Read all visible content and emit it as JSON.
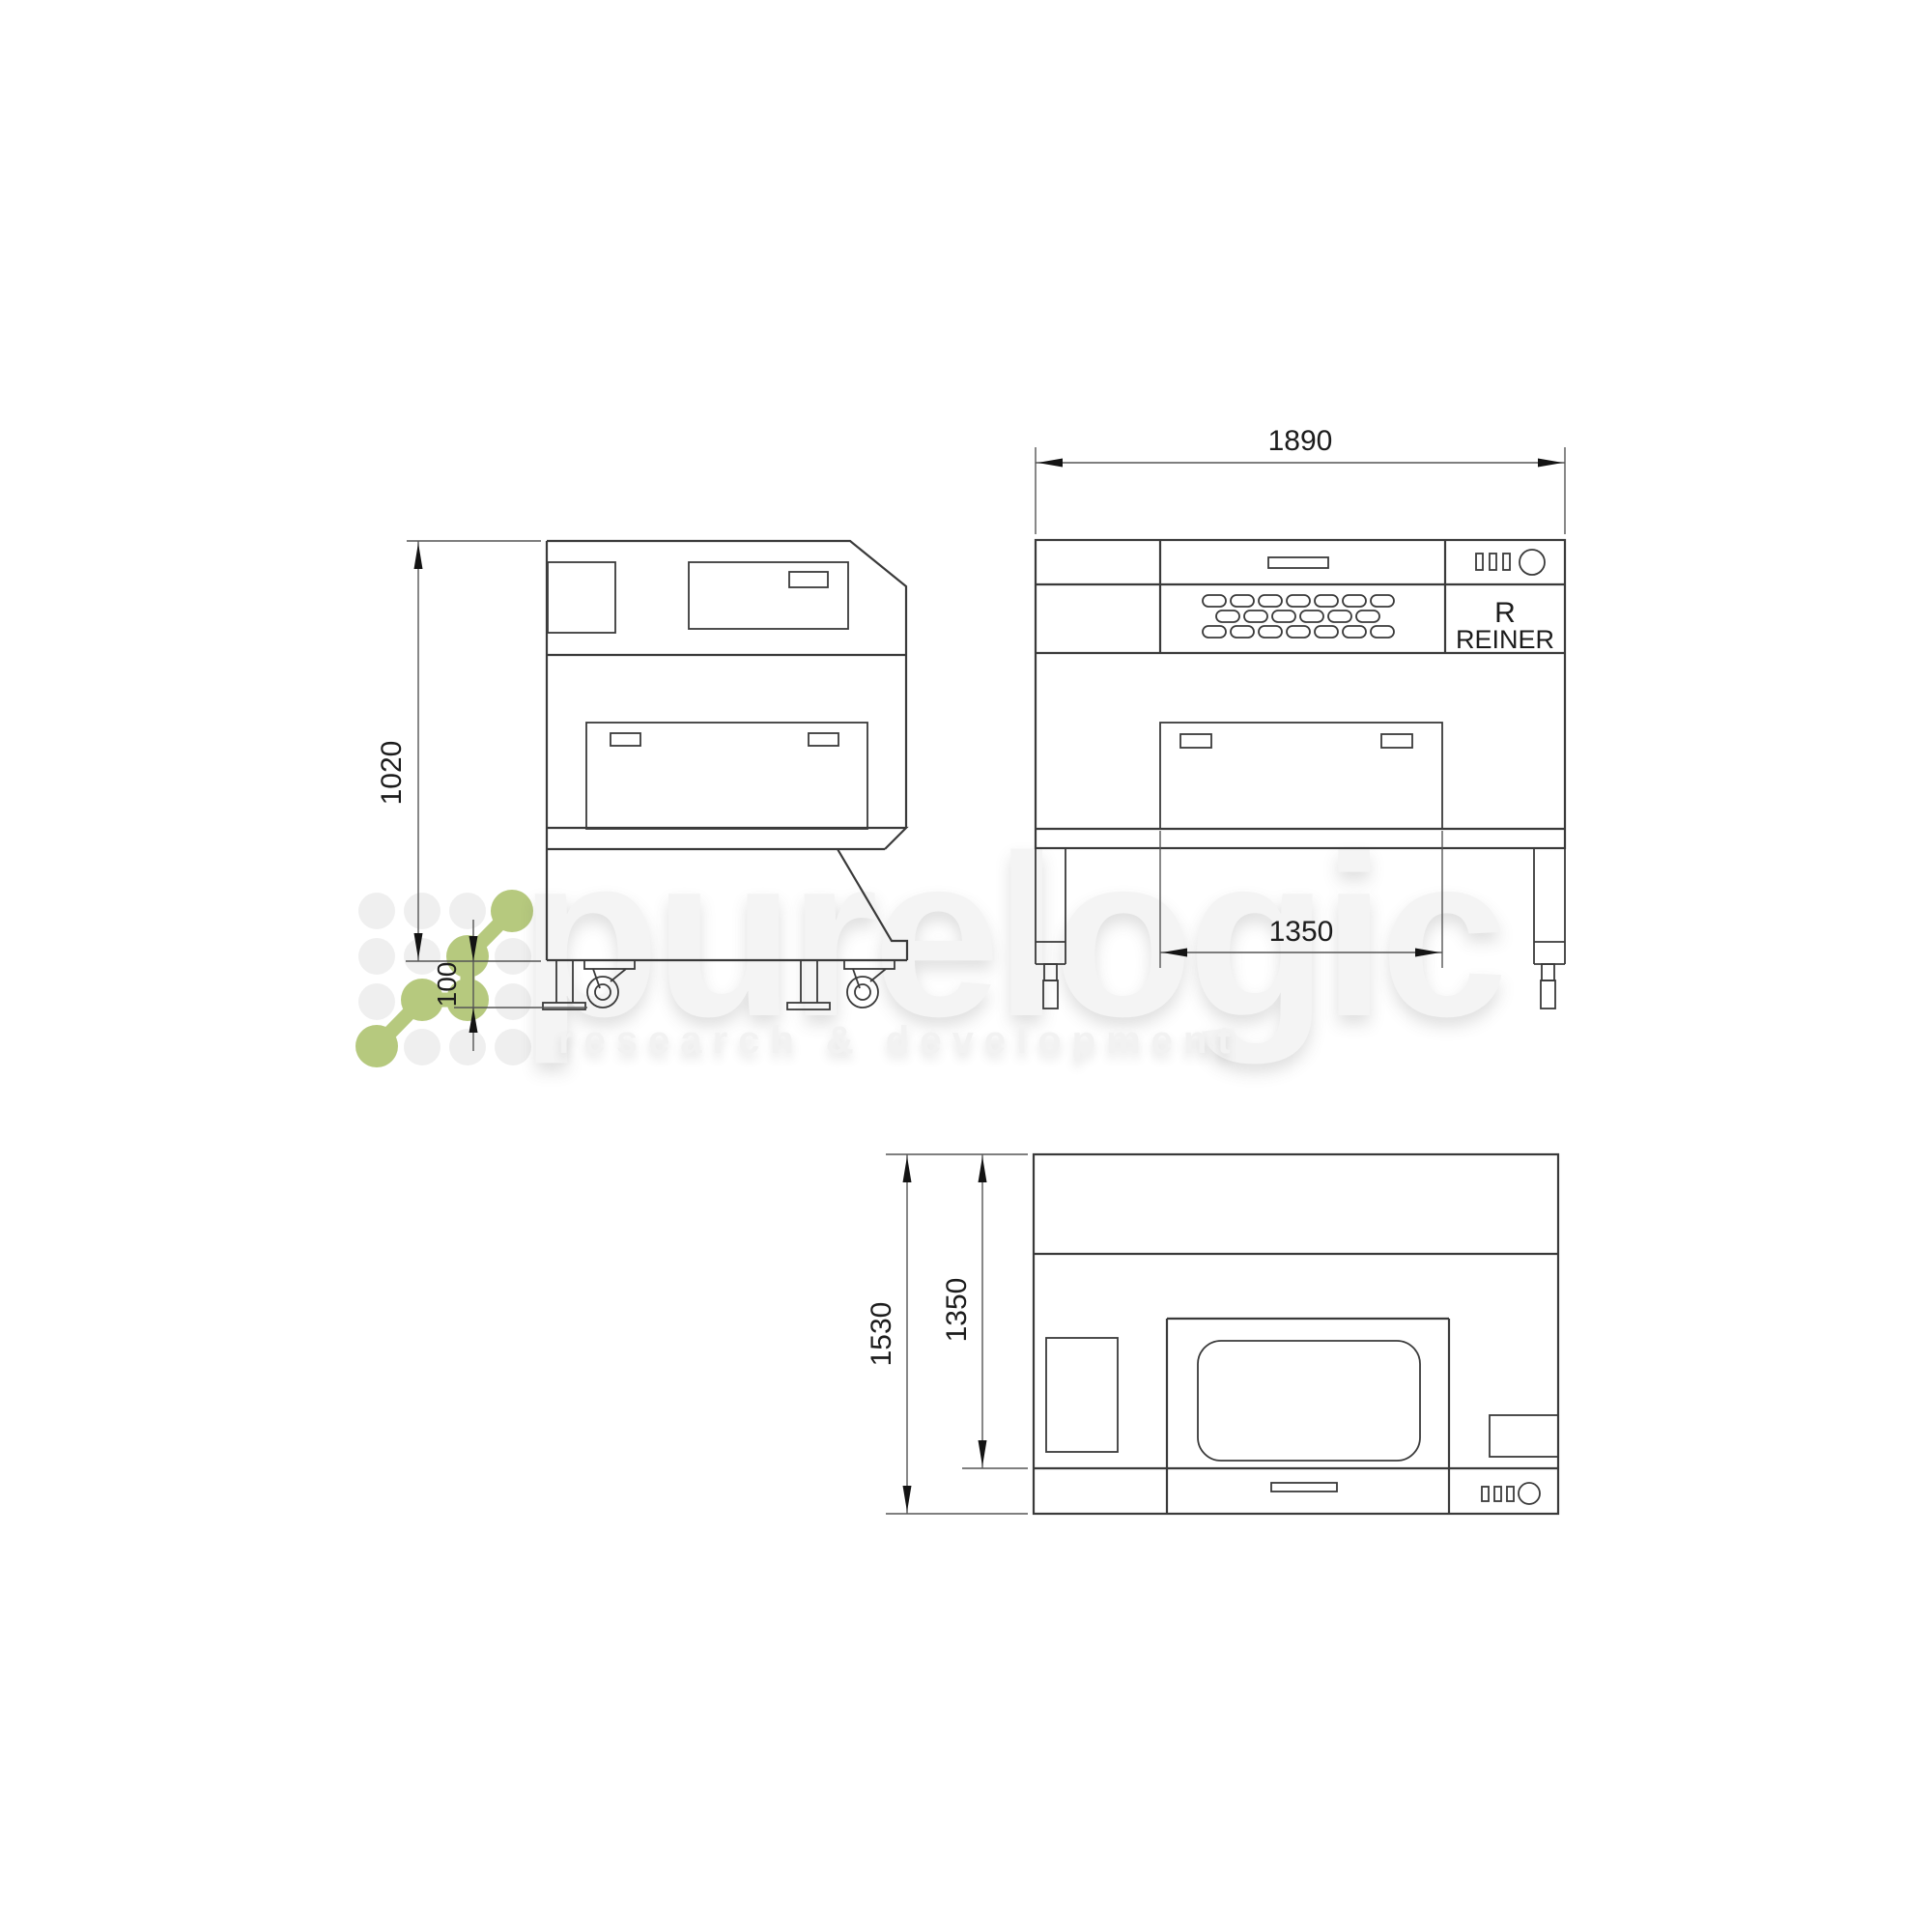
{
  "watermark": {
    "brand": "purelogic",
    "tagline": "research & development"
  },
  "drawing": {
    "front_view": {
      "overall_width": "1890",
      "table_width": "1350",
      "logo_letter": "R",
      "logo_name": "REINER"
    },
    "side_view": {
      "body_height": "1020",
      "foot_height": "100"
    },
    "top_view": {
      "overall_depth": "1530",
      "body_depth": "1350"
    }
  },
  "colors": {
    "line": "#3a3a3a",
    "dimension": "#555555",
    "accent_green": "#b6c97e",
    "watermark_gray": "#f4f4f4"
  }
}
